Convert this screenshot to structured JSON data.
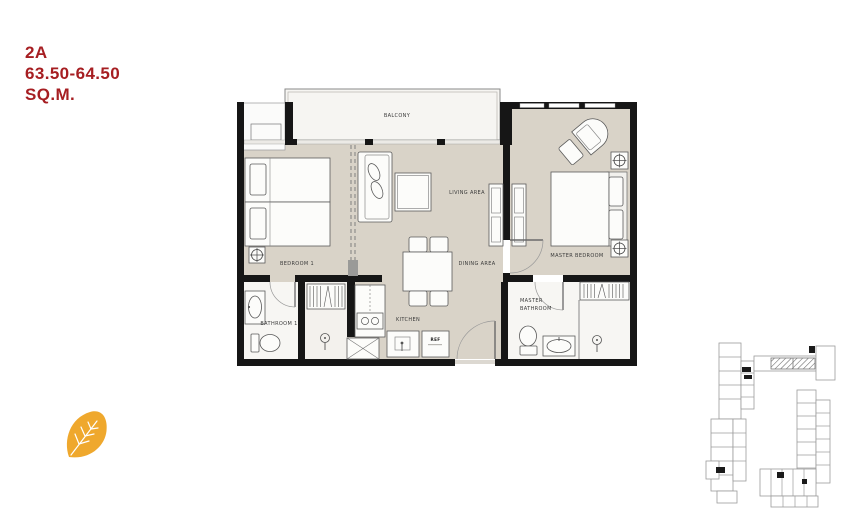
{
  "title": {
    "unit": "2A",
    "area": "63.50-64.50",
    "unit_suffix": "SQ.M."
  },
  "floor_plan": {
    "labels": {
      "balcony": "BALCONY",
      "bedroom1": "BEDROOM 1",
      "living_area": "LIVING AREA",
      "dining_area": "DINING AREA",
      "master_bedroom": "MASTER BEDROOM",
      "bathroom1": "BATHROOM 1",
      "kitchen": "KITCHEN",
      "master_bathroom_line1": "MASTER",
      "master_bathroom_line2": "BATHROOM",
      "refrigerator": "REF"
    },
    "colors": {
      "wall": "#161616",
      "floor": "#D9D3C8",
      "balcony_floor": "#F6F5F2",
      "bathroom_floor": "#F7F6F3",
      "furniture_outline": "#5a5a5a",
      "title_red": "#A61E22"
    }
  },
  "key_plan": {
    "description": "building-key-plan-with-unit-2a-highlighted",
    "outline_color": "#9b9b9b"
  },
  "leaf_icon": {
    "color": "#EFA82D"
  }
}
